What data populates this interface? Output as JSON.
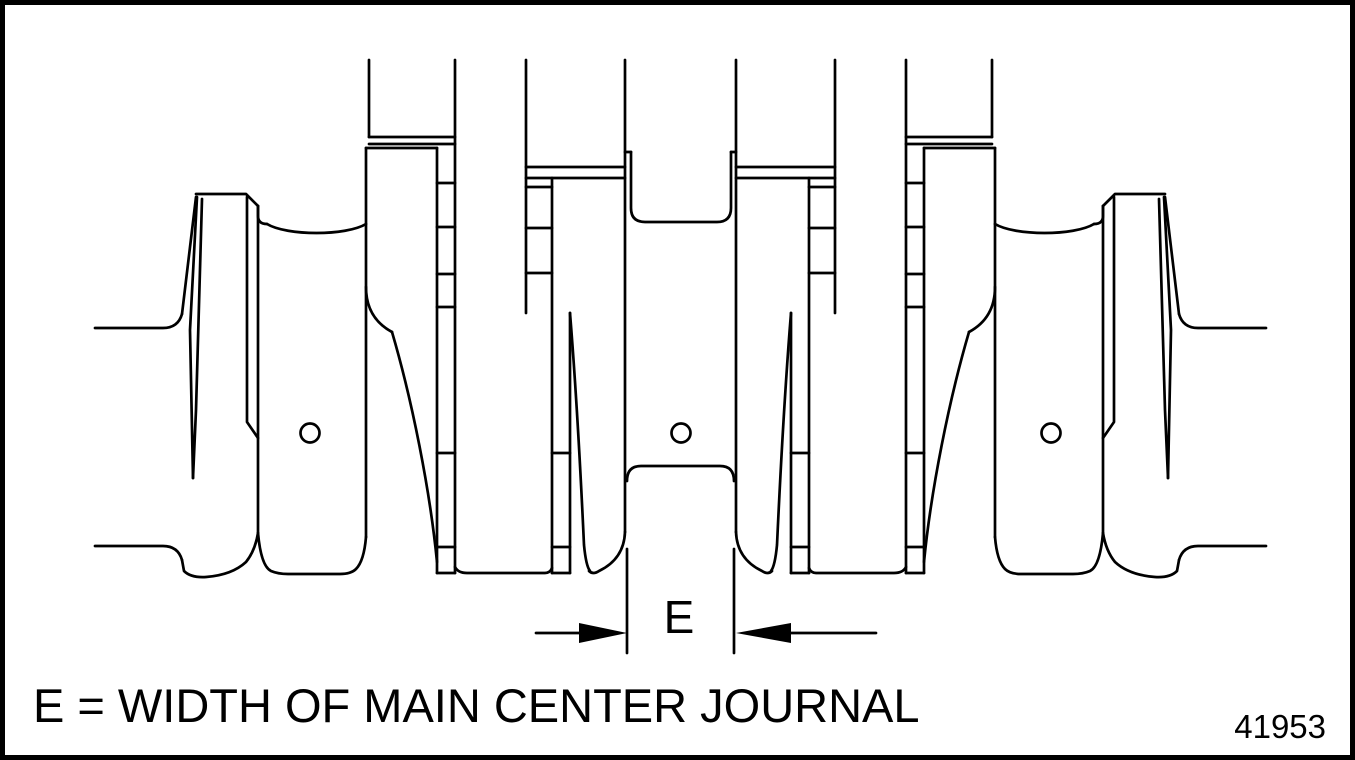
{
  "figure": {
    "type": "technical-line-drawing",
    "subject": "crankshaft side view with main center journal width dimension",
    "caption": "E = WIDTH OF MAIN CENTER JOURNAL",
    "figure_number": "41953",
    "dimension": {
      "label": "E"
    },
    "oil_hole_count": "3",
    "colors": {
      "line": "#000000",
      "background": "#ffffff"
    }
  }
}
